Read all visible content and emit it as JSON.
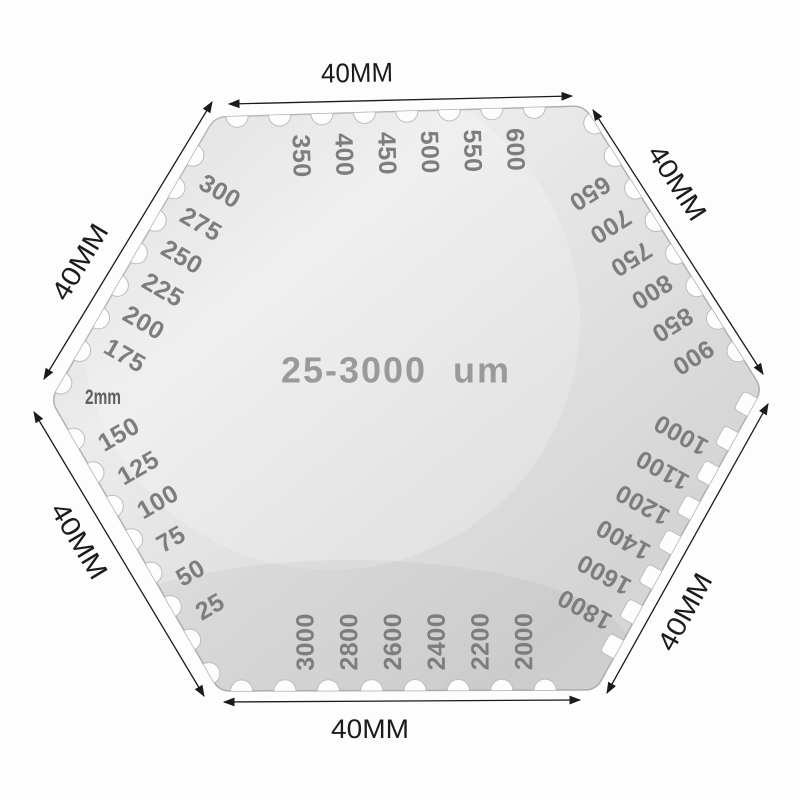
{
  "gauge": {
    "range_label": "25-3000 um",
    "thickness_label": "2mm",
    "side_dimension_label": "40MM",
    "edges": [
      {
        "side": "top",
        "values": [
          "350",
          "400",
          "450",
          "500",
          "550",
          "600"
        ]
      },
      {
        "side": "upper-right",
        "values": [
          "650",
          "700",
          "750",
          "800",
          "850",
          "900"
        ]
      },
      {
        "side": "lower-right",
        "values": [
          "1000",
          "1100",
          "1200",
          "1400",
          "1600",
          "1800"
        ]
      },
      {
        "side": "bottom",
        "values": [
          "3000",
          "2800",
          "2600",
          "2400",
          "2200",
          "2000"
        ]
      },
      {
        "side": "lower-left",
        "values": [
          "25",
          "50",
          "75",
          "100",
          "125",
          "150"
        ]
      },
      {
        "side": "upper-left",
        "values": [
          "175",
          "200",
          "225",
          "250",
          "275",
          "300"
        ]
      }
    ]
  },
  "colors": {
    "background": "#fdfdfd",
    "plate_light": "#ececec",
    "plate_mid": "#e0e0e0",
    "plate_dark": "#d2d2d2",
    "plate_stroke": "#b0b0b0",
    "notch_stroke": "#bdbdbd",
    "engraved_number": "#7d7d7d",
    "range_text": "#9a9a9a",
    "thickness_text": "#606060",
    "dimension_ink": "#1b1b1b"
  }
}
